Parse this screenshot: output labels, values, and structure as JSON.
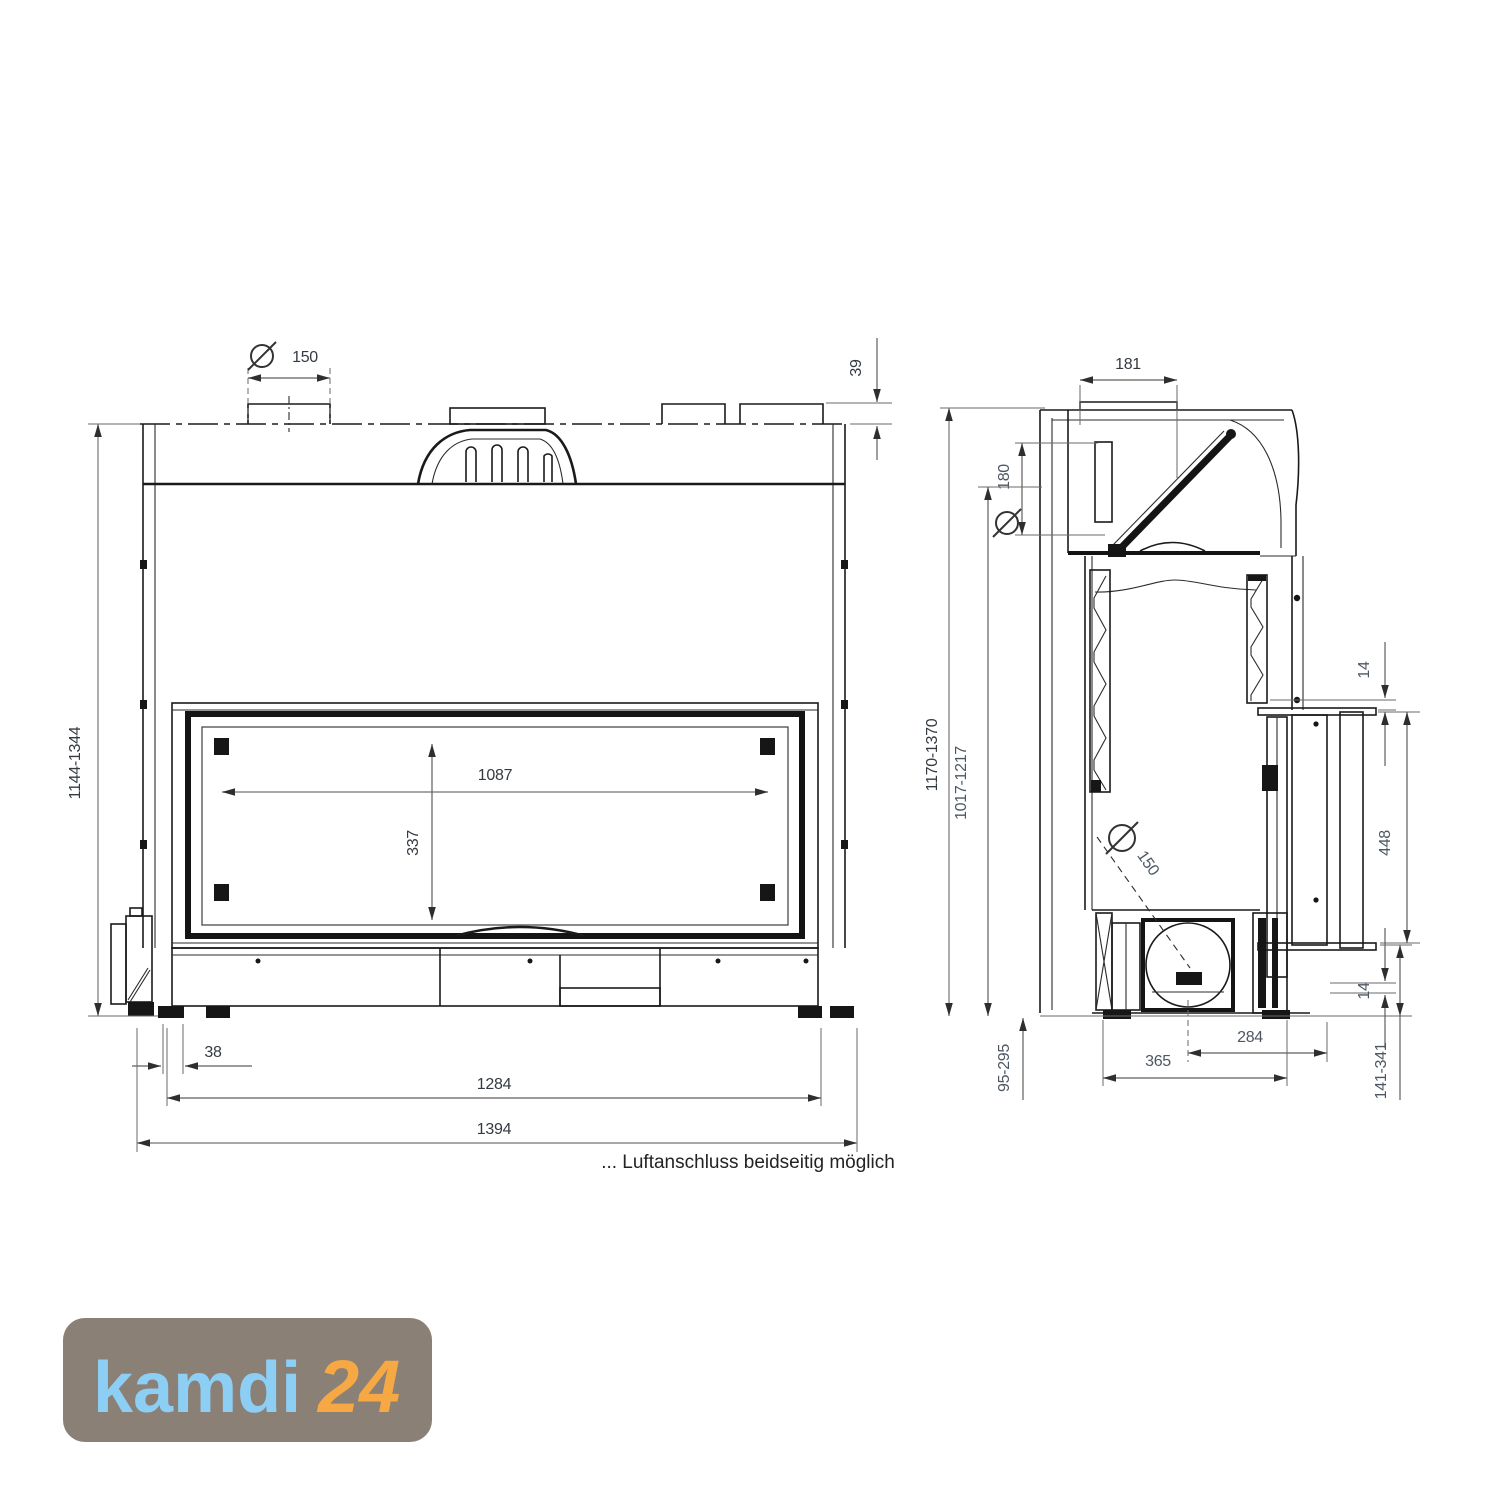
{
  "caption": "... Luftanschluss beidseitig möglich",
  "logo": {
    "brand": "kamdi",
    "suffix": "24"
  },
  "front_view": {
    "dims": {
      "flue_diameter": "150",
      "collar_height": "39",
      "overall_height": "1144-1344",
      "glass_width": "1087",
      "glass_height": "337",
      "frame_offset": "38",
      "body_width": "1284",
      "overall_width": "1394"
    }
  },
  "side_view": {
    "dims": {
      "flue_depth": "181",
      "flue_diameter": "180",
      "overall_height": "1170-1370",
      "body_height": "1017-1217",
      "top_gap": "14",
      "door_height": "448",
      "bottom_gap": "14",
      "air_inlet_diameter": "150",
      "plinth_height": "95-295",
      "base_depth": "365",
      "air_inlet_offset": "284",
      "bottom_clearance": "141-341"
    }
  },
  "colors": {
    "line": "#1a1a1a",
    "dim_line": "#6a6a6a",
    "dim_text": "#343a41",
    "side_dim_text": "#4d5763",
    "logo_bg": "#8a8076",
    "logo_brand": "#8ccef4",
    "logo_suffix": "#f5a843"
  }
}
